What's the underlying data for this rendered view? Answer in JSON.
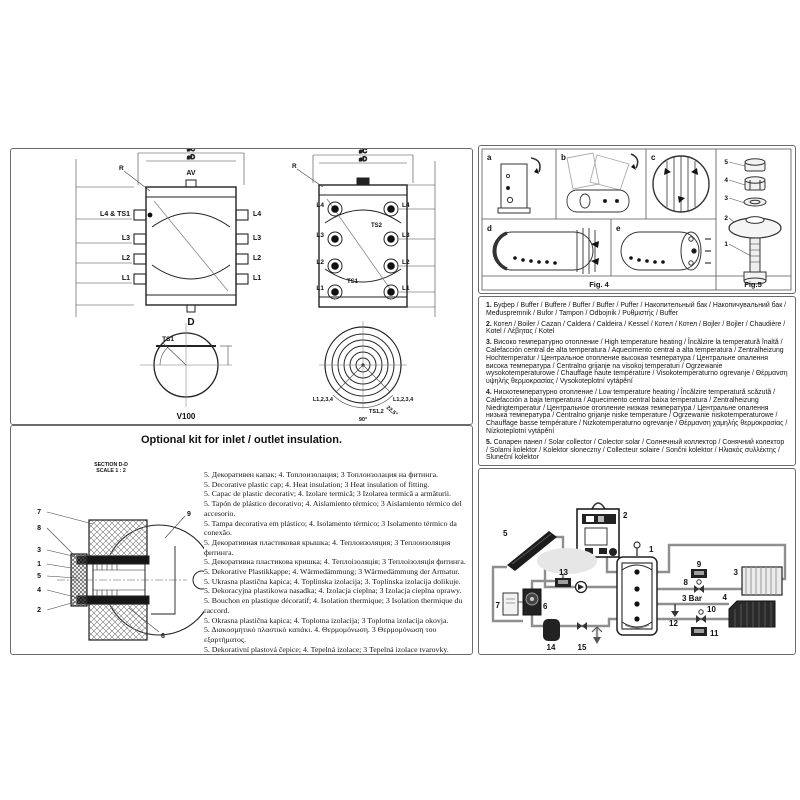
{
  "drawings": {
    "tank1": {
      "dim_outer": "⌀C",
      "dim_inner": "⌀D",
      "av": "AV",
      "r": "R",
      "left_ports": [
        "L4 & TS1",
        "L3",
        "L2",
        "L1"
      ],
      "right_ports": [
        "L4",
        "L3",
        "L2",
        "L1"
      ],
      "drain": "D",
      "ts1": "TS1",
      "caption": "V100"
    },
    "tank2": {
      "dim_outer": "⌀C",
      "dim_inner": "⌀D",
      "r": "R",
      "left_ports": [
        "L4",
        "L3",
        "L2",
        "L1"
      ],
      "right_ports": [
        "L4",
        "L3",
        "L2",
        "L1"
      ],
      "ts_top": "TS2",
      "ts_bottom": "TS1",
      "tv_left": "L1,2,3,4",
      "tv_right": "L1,2,3,4",
      "tv_ts": "TS1,2",
      "tv_angle": "90°",
      "tv_angle2": "22,5°",
      "caption": "V160 , V200"
    }
  },
  "fig4": {
    "caption": "Fig. 4",
    "cells": [
      "a",
      "b",
      "c",
      "d",
      "e"
    ]
  },
  "fig5": {
    "caption": "Fig.5",
    "callouts": [
      "5",
      "4",
      "3",
      "2",
      "1"
    ]
  },
  "legend": {
    "items": [
      {
        "num": "1.",
        "text": "Буфер / Buffer / Buffere / Buffer / Buffer / Puffer / Накопительный бак / Накопичувальний бак / Međuspremnik / Bufor / Tampon / Odbojnik / Ρυθμιστής / Buffer"
      },
      {
        "num": "2.",
        "text": "Котел / Boiler / Cazan / Caldera / Caldeira / Kessel / Котел / Котел / Bojler / Bojler / Chaudière / Kotel / Λέβητας / Kotel"
      },
      {
        "num": "3.",
        "text": "Високо температурно отопление / High temperature heating / Încălzire la temperatură înaltă / Calefacción central de alta temperatura / Aquecimento central a alta temperatura / Zentralheizung Hochtemperatur / Центральное отопление высокая температура / Центральне опалення висока температура / Centralno grijanje na visokoj temperaturi / Ogrzewanie wysokotemperaturowe / Chauffage haute température / Visokotemperaturno ogrevanje / Θέρμανση υψηλής θερμοκρασίας / Vysokoteplotní vytápění"
      },
      {
        "num": "4.",
        "text": "Нискотемпературно отопление / Low temperature heating / Încălzire temperaturǎ scăzută / Calefacción a baja temperatura / Aquecimento central baixa temperatura / Zentralheizung Niedrigtemperatur / Центральное отопление низкая температура / Центральне опалення низька температура / Centralno grijanje niske temperature / Ogrzewanie niskotemperaturowe / Chauffage basse température / Nizkotemperaturno ogrevanje / Θέρμανση χαμηλής θερμοκρασίας / Nízkoteplotní vytápění"
      },
      {
        "num": "5.",
        "text": "Соларен панел / Solar collector / Colector solar / Солнечный коллектор / Сонячний колектор / Solarni kolektor / Kolektor słoneczny / Collecteur solaire / Sončni kolektor / Ηλιακός συλλέκτης / Sluneční kolektor"
      }
    ]
  },
  "kit": {
    "title": "Optional kit for inlet / outlet insulation.",
    "section_line1": "SECTION D-D",
    "section_line2": "SCALE 1 : 2",
    "callouts": {
      "c7": "7",
      "c8": "8",
      "c3": "3",
      "c1": "1",
      "c5": "5",
      "c4": "4",
      "c2": "2",
      "c9": "9",
      "c6": "6"
    },
    "lines": [
      "5. Декоративен капак; 4. Топлоизолация; 3 Топлоизолация на фитинга.",
      "5. Decorative plastic cap; 4. Heat insulation; 3 Heat insulation of fitting.",
      "5. Capac de plastic decorativ; 4. Izolare termică; 3 Izolarea termică a armăturii.",
      "5. Tapón de plástico decorativo; 4. Aislamiento térmico; 3 Aislamiento térmico del accesorio.",
      "5. Tampa decorativa em plástico; 4. Isolamento térmico; 3 Isolamento térmico da conexão.",
      "5. Декоративная пластиковая крышка; 4. Теплоизоляция; 3 Теплоизоляция фитинга.",
      "5. Декоративна пластикова кришка; 4. Теплоізоляція; 3 Теплоізоляція фитинга.",
      "5. Dekorative Plastikkappe; 4. Wärmedämmung; 3 Wärmedämmung der Armatur.",
      "5. Ukrasna plastična kapica; 4. Toplinska izolacija; 3. Toplinska izolacija dolikuje.",
      "5. Dekoracyjna plastikowa nasadka; 4. Izolacja cieplna; 3 Izolacja cieplna oprawy.",
      "5. Bouchon en plastique décoratif; 4. Isolation thermique; 3 Isolation thermique du raccord.",
      "5. Okrasna plastična kapica; 4. Toplotna izolacija; 3 Toplotna izolacija okovja.",
      "5. Διακοσμητικό πλαστικό καπάκι. 4. Θερμομόνωση. 3 Θερμομόνωση του εξαρτήματος.",
      "5. Dekorativní plastová čepice; 4. Tepelná izolace; 3 Tepelná izolace tvarovky."
    ]
  },
  "schematic": {
    "n1": "1",
    "n2": "2",
    "n3": "3",
    "n4": "4",
    "n5": "5",
    "n6": "6",
    "n7": "7",
    "n8": "8",
    "n9": "9",
    "n10": "10",
    "n11": "11",
    "n12": "12",
    "n13": "13",
    "n14": "14",
    "n15": "15",
    "bar": "3 Bar"
  }
}
